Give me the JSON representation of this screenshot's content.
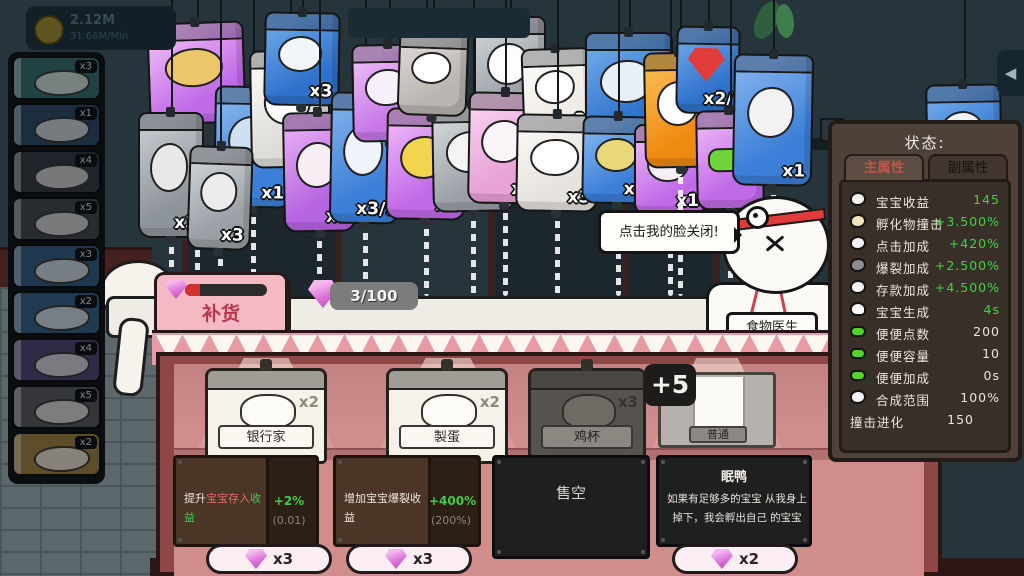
{
  "colors": {
    "green": "#3ed43e",
    "red_text": "#e06a6a",
    "panel_bg": "#4d413a",
    "shop_pink": "#d18c8c"
  },
  "hud": {
    "money": "2.12M",
    "rate": "31.66M/Min"
  },
  "sidebar": {
    "items": [
      {
        "count": "x3",
        "bg": "#2e6d6d"
      },
      {
        "count": "x1",
        "bg": "#27496a"
      },
      {
        "count": "x4",
        "bg": "#333b45"
      },
      {
        "count": "x5",
        "bg": "#3f454d"
      },
      {
        "count": "x3",
        "bg": "#2d5c86"
      },
      {
        "count": "x2",
        "bg": "#2d608a"
      },
      {
        "count": "x4",
        "bg": "#4f4278"
      },
      {
        "count": "x5",
        "bg": "#53575c"
      },
      {
        "count": "x2",
        "bg": "#9c7c38"
      }
    ]
  },
  "bags": [
    {
      "x": 148,
      "y": 22,
      "w": 97,
      "h": 102,
      "c": "#c06ae8",
      "c2": "#edb3f6",
      "count": "x1",
      "blob": "#eec66a",
      "rot": -2,
      "drip": true,
      "icon": "nest-babies"
    },
    {
      "x": 214,
      "y": 86,
      "w": 78,
      "h": 122,
      "c": "#3c7fd8",
      "c2": "#7fb0ea",
      "count": "x1",
      "blob": "#cfe0f2",
      "rot": 1,
      "drip": true,
      "icon": "beads"
    },
    {
      "x": 250,
      "y": 50,
      "w": 80,
      "h": 118,
      "c": "#dddcd8",
      "c2": "#f6f5f2",
      "count": "x2",
      "blob": "#ffffff",
      "rot": -1,
      "drip": false,
      "icon": "bunny-eggs"
    },
    {
      "x": 264,
      "y": 12,
      "w": 76,
      "h": 94,
      "c": "#2f72cc",
      "c2": "#66a2e6",
      "count": "x3",
      "blob": "#f2f6fa",
      "rot": 1,
      "drip": false,
      "icon": "sheep"
    },
    {
      "x": 138,
      "y": 112,
      "w": 66,
      "h": 126,
      "c": "#8e959a",
      "c2": "#bfc6ca",
      "count": "x3",
      "blob": "#e8e8e8",
      "rot": 0,
      "drip": true,
      "icon": "gray-item"
    },
    {
      "x": 188,
      "y": 146,
      "w": 64,
      "h": 104,
      "c": "#9aa0a5",
      "c2": "#c9ced2",
      "count": "x3",
      "blob": "#ececec",
      "rot": 2,
      "drip": true,
      "icon": "gray-item"
    },
    {
      "x": 283,
      "y": 112,
      "w": 72,
      "h": 120,
      "c": "#b565e0",
      "c2": "#e2a6f2",
      "count": "x1",
      "blob": "#f6eef2",
      "rot": -1,
      "drip": true,
      "icon": "intestines"
    },
    {
      "x": 330,
      "y": 92,
      "w": 70,
      "h": 132,
      "c": "#3c7fd8",
      "c2": "#79aae8",
      "count": "x3/:",
      "blob": "#eef4fa",
      "rot": 1,
      "drip": true,
      "icon": "bones"
    },
    {
      "x": 352,
      "y": 44,
      "w": 74,
      "h": 98,
      "c": "#c777e8",
      "c2": "#eab6f6",
      "count": "x2",
      "blob": "#f6f0fa",
      "rot": -1,
      "drip": false,
      "icon": "sword"
    },
    {
      "x": 386,
      "y": 108,
      "w": 80,
      "h": 112,
      "c": "#c06ae8",
      "c2": "#eaaef6",
      "count": "x2",
      "blob": "#f2d44e",
      "rot": 1,
      "drip": true,
      "icon": "moon"
    },
    {
      "x": 432,
      "y": 104,
      "w": 82,
      "h": 108,
      "c": "#9aa0a5",
      "c2": "#cdd2d5",
      "count": "x2",
      "blob": "#f4f4f4",
      "rot": -1,
      "drip": true,
      "icon": "trampoline"
    },
    {
      "x": 398,
      "y": 30,
      "w": 70,
      "h": 86,
      "c": "#b9b5b0",
      "c2": "#dad7d3",
      "count": "",
      "blob": "#ffffff",
      "rot": 2,
      "drip": false,
      "icon": "figure"
    },
    {
      "x": 474,
      "y": 16,
      "w": 72,
      "h": 108,
      "c": "#9aa0a5",
      "c2": "#c8cdd1",
      "count": "",
      "blob": "#fdfdfd",
      "rot": 0,
      "drip": false,
      "icon": "airplane"
    },
    {
      "x": 468,
      "y": 92,
      "w": 74,
      "h": 112,
      "c": "#e7a2d8",
      "c2": "#f7ccec",
      "count": "x2",
      "blob": "#fbf4f8",
      "rot": 1,
      "drip": true,
      "icon": "cat-face"
    },
    {
      "x": 522,
      "y": 48,
      "w": 70,
      "h": 88,
      "c": "#efece6",
      "c2": "#fbf9f6",
      "count": "x3",
      "blob": "#ffffff",
      "rot": -2,
      "drip": false,
      "icon": "cat"
    },
    {
      "x": 516,
      "y": 114,
      "w": 82,
      "h": 98,
      "c": "#e6e3de",
      "c2": "#f8f6f2",
      "count": "x3",
      "blob": "#ffffff",
      "rot": 1,
      "drip": true,
      "icon": "plate"
    },
    {
      "x": 585,
      "y": 32,
      "w": 88,
      "h": 112,
      "c": "#2f72cc",
      "c2": "#69a4e8",
      "count": "x4",
      "blob": "#e8f0f8",
      "rot": 0,
      "drip": false,
      "icon": "couch"
    },
    {
      "x": 582,
      "y": 116,
      "w": 72,
      "h": 88,
      "c": "#3c7fd8",
      "c2": "#7db0ec",
      "count": "x2",
      "blob": "#e8d87a",
      "rot": 1,
      "drip": true,
      "icon": "coins"
    },
    {
      "x": 634,
      "y": 124,
      "w": 72,
      "h": 92,
      "c": "#c06ae8",
      "c2": "#e8b0f4",
      "count": "x1",
      "blob": "#f4eef8",
      "rot": 0,
      "drip": true,
      "icon": "purple-item"
    },
    {
      "x": 644,
      "y": 52,
      "w": 72,
      "h": 116,
      "c": "#ef8a10",
      "c2": "#f8b84a",
      "count": "",
      "blob": "#fdfdfd",
      "rot": -1,
      "drip": true,
      "icon": "goose"
    },
    {
      "x": 676,
      "y": 26,
      "w": 64,
      "h": 88,
      "c": "#2f72cc",
      "c2": "#68a2e6",
      "count": "x2/",
      "blob": "#e03c3c",
      "rot": 1,
      "drip": false,
      "icon": "ruby",
      "gem": true
    },
    {
      "x": 696,
      "y": 110,
      "w": 68,
      "h": 100,
      "c": "#c06ae8",
      "c2": "#e9aef6",
      "count": "",
      "blob": "#6ed43a",
      "rot": -1,
      "drip": true,
      "icon": "caterpillar",
      "pill": true
    },
    {
      "x": 733,
      "y": 54,
      "w": 80,
      "h": 132,
      "c": "#3c7fd8",
      "c2": "#7aacea",
      "count": "x1",
      "blob": "#f2f2f2",
      "rot": 1,
      "drip": true,
      "icon": "lamp"
    },
    {
      "x": 926,
      "y": 84,
      "w": 76,
      "h": 108,
      "c": "#2f72cc",
      "c2": "#69a4e8",
      "count": "x1",
      "blob": "#eef4fa",
      "rot": -1,
      "drip": false,
      "icon": "whale"
    }
  ],
  "counter": {
    "restock_label": "补货",
    "gem_count": "3/100"
  },
  "doctor": {
    "speech": "点击我的脸关闭!",
    "name_tag": "食物医生"
  },
  "stats_panel": {
    "title": "状态:",
    "tabs": [
      {
        "label": "主属性",
        "active": true
      },
      {
        "label": "副属性",
        "active": false
      }
    ],
    "rows": [
      {
        "icon": "baby-icon",
        "label": "宝宝收益",
        "value": "145",
        "green": true
      },
      {
        "icon": "hatch-icon",
        "label": "孵化物撞击",
        "value": "+3.500%",
        "green": true
      },
      {
        "icon": "click-icon",
        "label": "点击加成",
        "value": "+420%",
        "green": true
      },
      {
        "icon": "burst-icon",
        "label": "爆裂加成",
        "value": "+2.500%",
        "green": true
      },
      {
        "icon": "deposit-icon",
        "label": "存款加成",
        "value": "+4.500%",
        "green": true
      },
      {
        "icon": "goose-icon",
        "label": "宝宝生成",
        "value": "4s",
        "green": true
      },
      {
        "icon": "worm-icon",
        "label": "便便点数",
        "value": "200",
        "green": false
      },
      {
        "icon": "worm-icon",
        "label": "便便容量",
        "value": "10",
        "green": false
      },
      {
        "icon": "worm-icon",
        "label": "便便加成",
        "value": "0s",
        "green": false
      },
      {
        "icon": "flower-icon",
        "label": "合成范围",
        "value": "100%",
        "green": false
      }
    ],
    "footer": {
      "label": "撞击进化",
      "value": "150"
    }
  },
  "shop": {
    "items": [
      {
        "label": "银行家",
        "count": "x2",
        "style": "light",
        "x": 205,
        "w": 122
      },
      {
        "label": "製蛋",
        "count": "x2",
        "style": "light",
        "x": 386,
        "w": 122
      },
      {
        "label": "鸡杯",
        "count": "x3",
        "style": "dark",
        "x": 528,
        "w": 118
      }
    ],
    "poster": {
      "label": "普通",
      "badge": "+5"
    },
    "upgrades": [
      {
        "type": "upgrade",
        "x": 173,
        "w": 146,
        "parts": [
          {
            "t": "提升",
            "c": "#efe9e1"
          },
          {
            "t": "宝宝存入",
            "c": "#e06a6a"
          },
          {
            "t": "收益",
            "c": "#4ec84e"
          }
        ],
        "value": "+2%",
        "sub": "(0.01)"
      },
      {
        "type": "upgrade",
        "x": 333,
        "w": 148,
        "parts": [
          {
            "t": "增加宝宝爆裂收益",
            "c": "#efe9e1"
          }
        ],
        "value": "+400%",
        "sub": "(200%)"
      },
      {
        "type": "soldout",
        "x": 492,
        "w": 158,
        "text": "售空"
      },
      {
        "type": "info",
        "x": 656,
        "w": 156,
        "title": "眠鸭",
        "desc": "如果有足够多的宝宝 从我身上掉下，我会孵出自己 的宝宝"
      }
    ],
    "prices": [
      {
        "x": 206,
        "w": 126,
        "label": "x3"
      },
      {
        "x": 346,
        "w": 126,
        "label": "x3"
      },
      {
        "x": 672,
        "w": 126,
        "label": "x2"
      }
    ]
  }
}
